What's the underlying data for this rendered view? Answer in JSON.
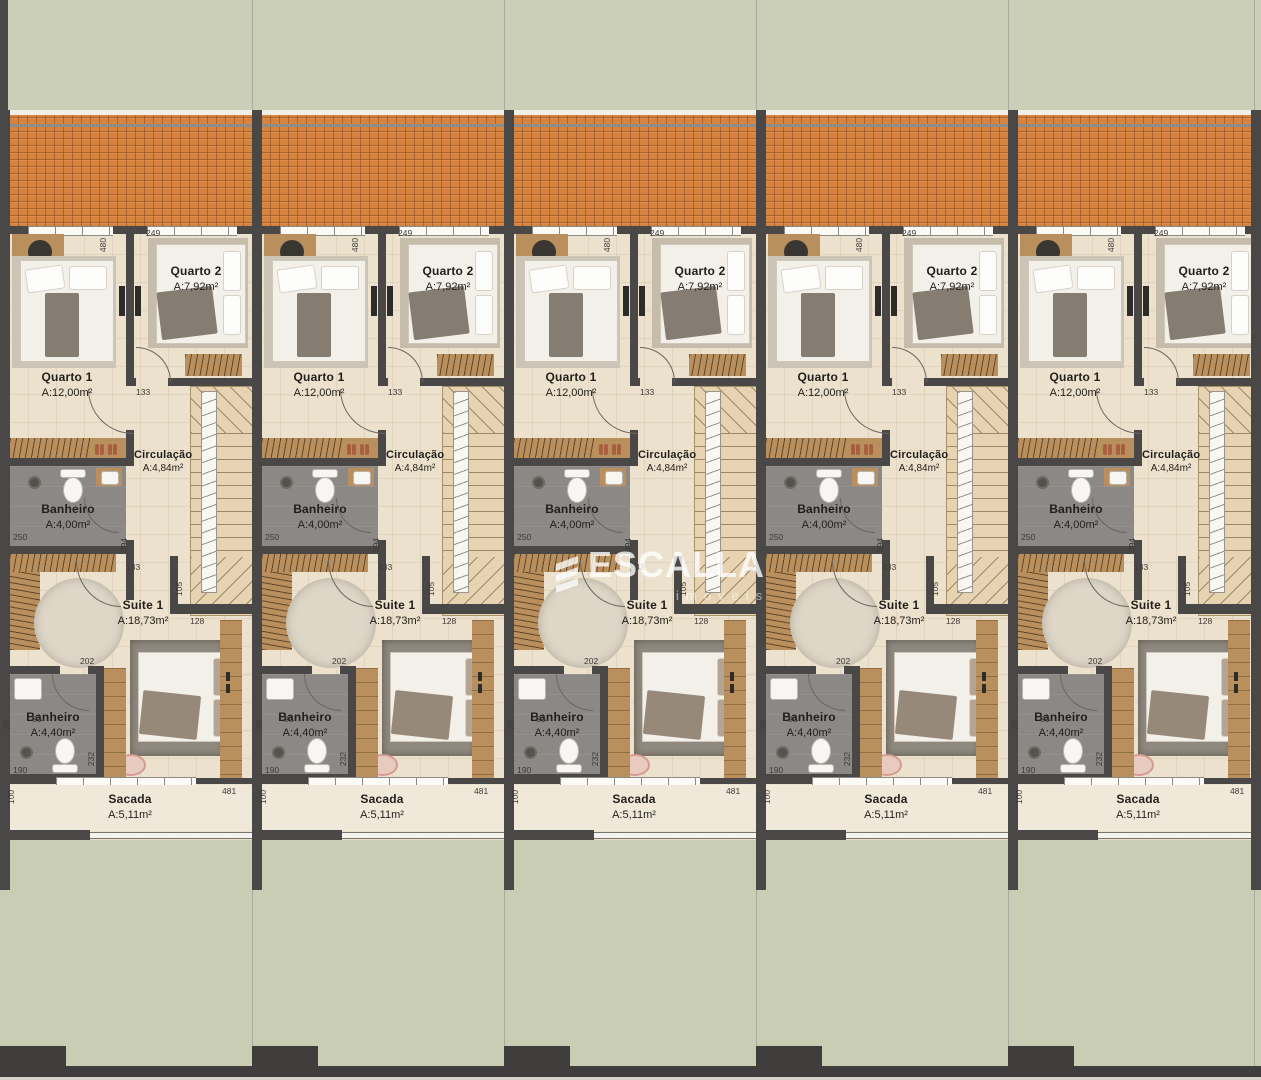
{
  "watermark": {
    "brand": "ESCALLA",
    "tagline": "imóveis"
  },
  "units": {
    "count": 5
  },
  "rooms": {
    "quarto1": {
      "name": "Quarto 1",
      "area": "A:12,00m²"
    },
    "quarto2": {
      "name": "Quarto 2",
      "area": "A:7,92m²"
    },
    "circulacao": {
      "name": "Circulação",
      "area": "A:4,84m²"
    },
    "banheiro_sup": {
      "name": "Banheiro",
      "area": "A:4,00m²"
    },
    "suite": {
      "name": "Suite 1",
      "area": "A:18,73m²"
    },
    "banheiro_suite": {
      "name": "Banheiro",
      "area": "A:4,40m²"
    },
    "sacada": {
      "name": "Sacada",
      "area": "A:5,11m²"
    }
  },
  "dims": {
    "d480": "480",
    "d249": "249",
    "d133": "133",
    "d394": "394",
    "d105": "105",
    "d128": "128",
    "d250": "250",
    "d202": "202",
    "d90": "90",
    "d190": "190",
    "d232": "232",
    "d100": "100",
    "d481": "481",
    "d20": "20"
  },
  "colors": {
    "grass": "#cbcfb8",
    "roof_tile": "#d6833f",
    "wall": "#4a4846",
    "floor": "#ece1cc",
    "bathroom": "#8b8885",
    "wood": "#b98f5e",
    "watermark": "#ffffff"
  }
}
